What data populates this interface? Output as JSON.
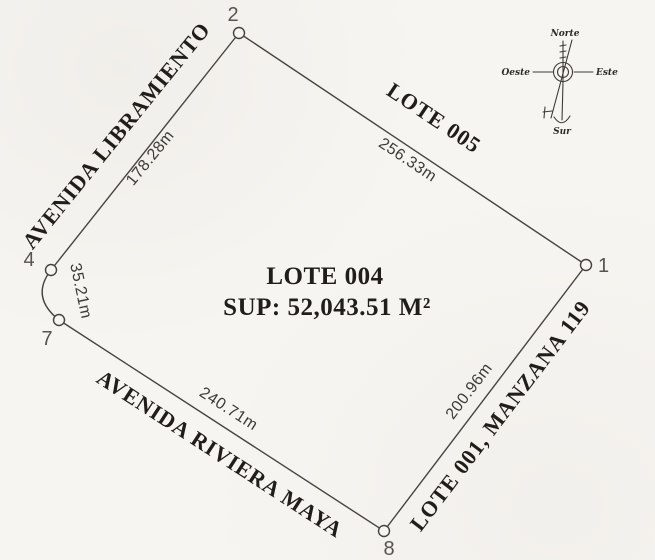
{
  "lot": {
    "name": "LOTE 004",
    "surface": "SUP: 52,043.51 M²"
  },
  "vertex_labels": [
    "1",
    "2",
    "4",
    "7",
    "8"
  ],
  "edges": [
    {
      "side": "northwest",
      "length": "178.28m",
      "neighbor": "AVENIDA LIBRAMIENTO"
    },
    {
      "side": "northeast",
      "length": "256.33m",
      "neighbor": "LOTE 005"
    },
    {
      "side": "southeast",
      "length": "200.96m",
      "neighbor": "LOTE 001, MANZANA 119"
    },
    {
      "side": "southwest",
      "length": "240.71m",
      "neighbor": "AVENIDA RIVIERA MAYA"
    },
    {
      "side": "west-arc",
      "length": "35.21m",
      "neighbor": ""
    }
  ],
  "compass": {
    "north": "Norte",
    "south": "Sur",
    "east": "Este",
    "west": "Oeste"
  },
  "colors": {
    "ink": "#47443f",
    "paper": "#f7f5f1",
    "text": "#211e1a"
  }
}
